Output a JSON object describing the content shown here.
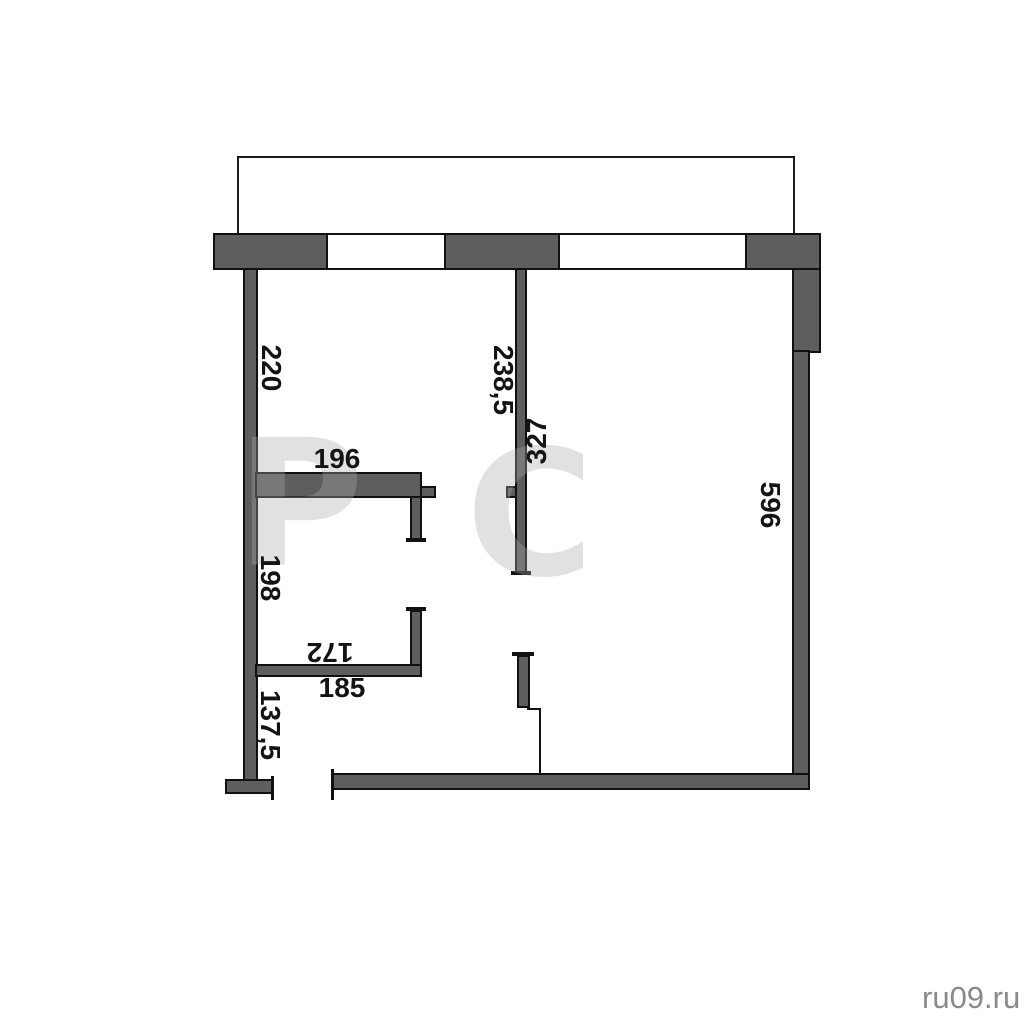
{
  "plan": {
    "dimensions": {
      "left_top": "220",
      "hall_top": "196",
      "partition_left": "238,5",
      "partition_right": "327",
      "right_wall": "596",
      "left_middle": "198",
      "closet_top": "172",
      "closet_bottom": "185",
      "left_bottom": "137,5"
    },
    "watermark": {
      "letter1": "Р",
      "letter2": "С"
    },
    "footer": {
      "site": "ru09.ru"
    }
  }
}
